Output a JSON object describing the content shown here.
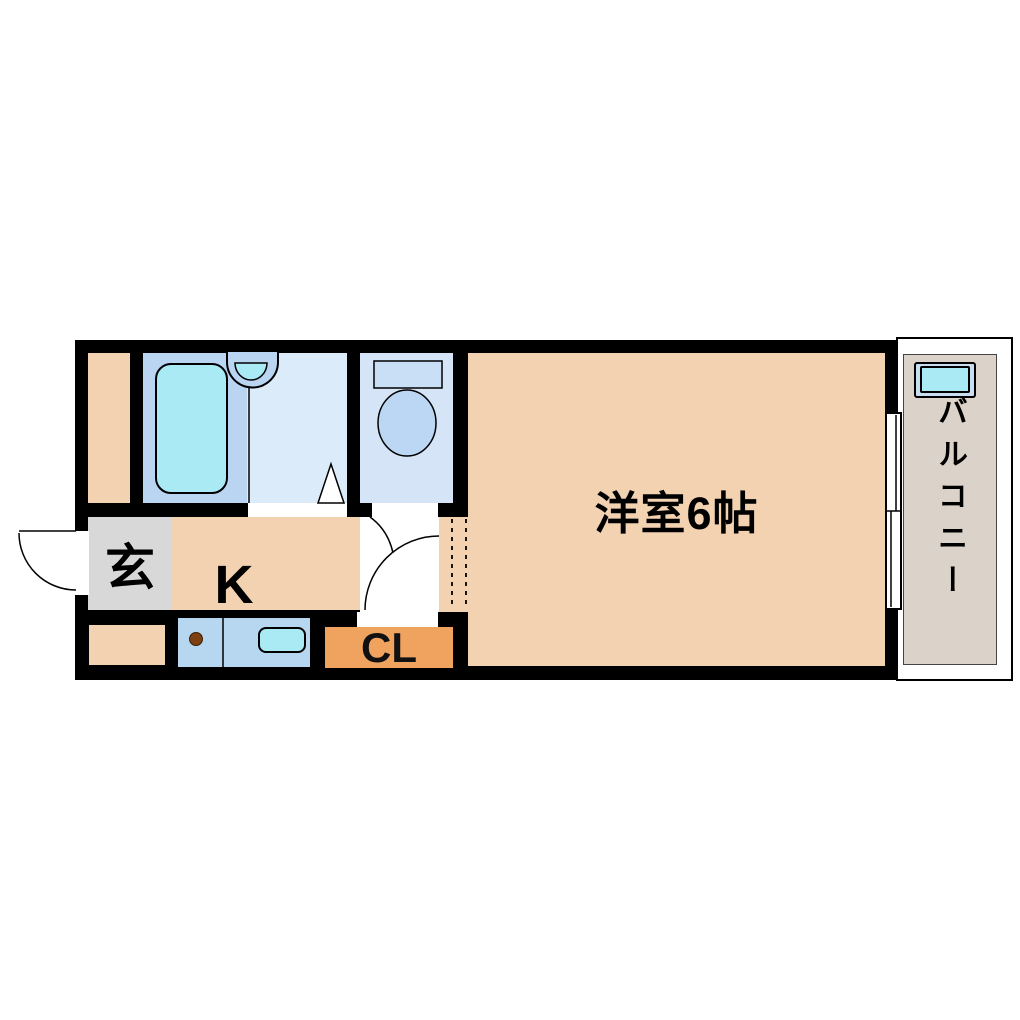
{
  "plan": {
    "type": "apartment-floor-plan",
    "rooms": {
      "entrance": {
        "label": "玄"
      },
      "kitchen": {
        "label": "K"
      },
      "main_room": {
        "label": "洋室6帖"
      },
      "closet": {
        "label": "CL"
      },
      "balcony": {
        "label": "バルコニー"
      }
    },
    "fixtures": [
      "bathtub",
      "shower-basin",
      "toilet",
      "kitchen-sink",
      "stove-burner",
      "washing-machine-pan",
      "sliding-window",
      "entrance-door-swing",
      "room-door-swing",
      "toilet-door-swing",
      "washroom-door-triangle"
    ],
    "colors": {
      "floor_peach": "#f3d2b1",
      "entrance_gray": "#d8d8d8",
      "bath_blue": "#b9d5f1",
      "washroom_blue": "#dcebfa",
      "toilet_blue": "#d5e5f7",
      "counter_blue": "#b7d6f0",
      "fixture_cyan": "#a9eaf5",
      "closet_orange": "#efa35f",
      "balcony_gray": "#dbd3ca",
      "pan_blue": "#c9def1",
      "toilet_fixture_blue": "#bcd7f3",
      "tank_blue": "#c8dff5",
      "burner_brown": "#7d4012",
      "wall_black": "#000000"
    }
  }
}
